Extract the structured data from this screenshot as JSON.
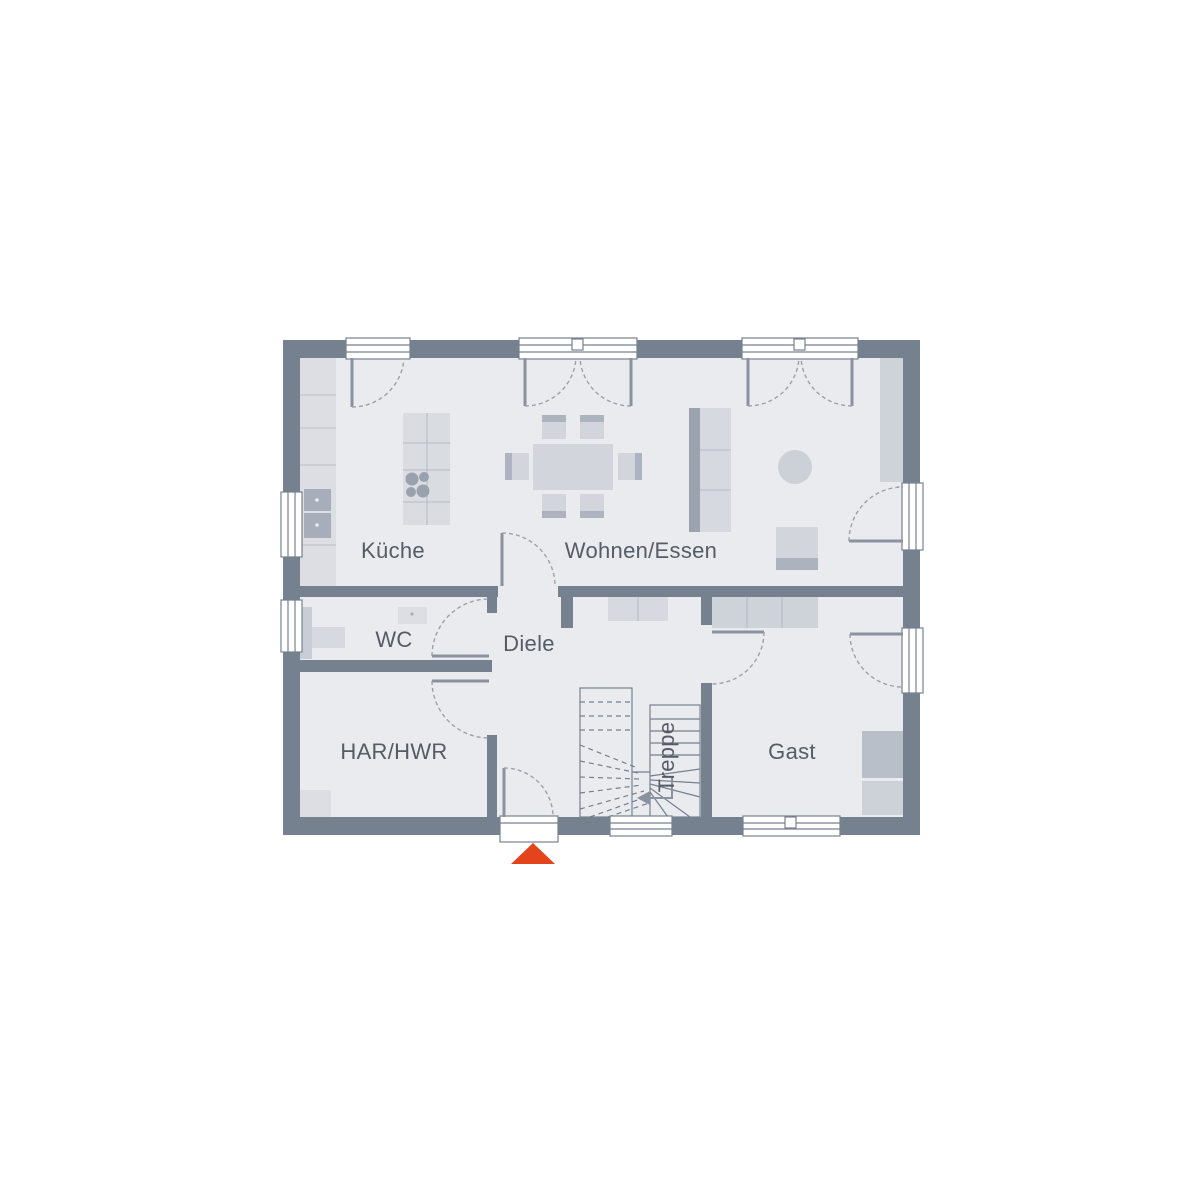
{
  "floorplan": {
    "labels": {
      "kueche": "Küche",
      "wohnen_essen": "Wohnen/Essen",
      "wc": "WC",
      "diele": "Diele",
      "har_hwr": "HAR/HWR",
      "gast": "Gast",
      "treppe": "Treppe"
    },
    "colors": {
      "wall": "#76818F",
      "floor": "#E9EBEF",
      "furniture_light": "#D9DCE2",
      "furniture_mid": "#CDD1D8",
      "furniture_dark": "#ABB1BC",
      "label_text": "#555C66",
      "entrance_marker": "#E3441B"
    }
  }
}
